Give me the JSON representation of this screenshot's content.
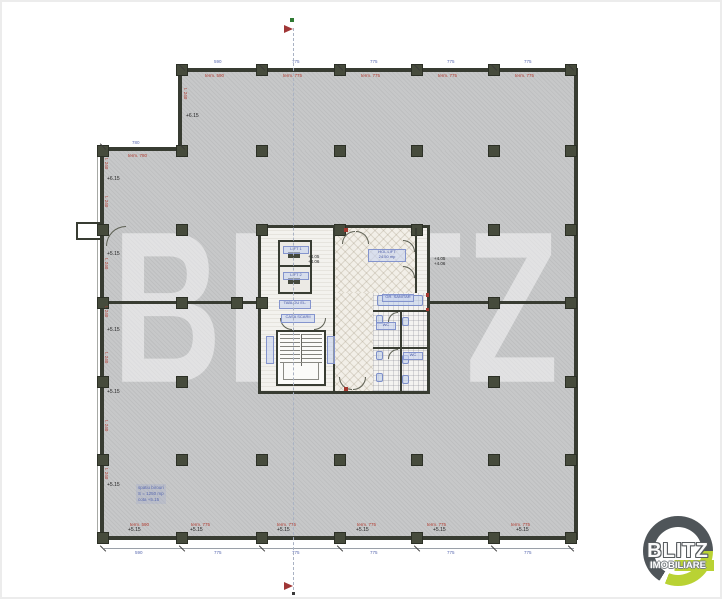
{
  "watermark": {
    "text": "BLITZ"
  },
  "logo": {
    "title": "BLITZ",
    "subtitle": "IMOBILIARE",
    "colors": {
      "ring": "#4f5559",
      "accent": "#b9d233"
    }
  },
  "colors": {
    "floor": "#c7c8c9",
    "wall": "#383c32",
    "column": "#464b3c",
    "red_text": "#b03a2e",
    "blue_text": "#5a6ab0",
    "core_floor": "#f3f2ee"
  },
  "plan": {
    "columns": [
      [
        182,
        70
      ],
      [
        262,
        70
      ],
      [
        340,
        70
      ],
      [
        417,
        70
      ],
      [
        494,
        70
      ],
      [
        571,
        70
      ],
      [
        103,
        151
      ],
      [
        182,
        151
      ],
      [
        262,
        151
      ],
      [
        340,
        151
      ],
      [
        417,
        151
      ],
      [
        494,
        151
      ],
      [
        571,
        151
      ],
      [
        103,
        230
      ],
      [
        182,
        230
      ],
      [
        262,
        230
      ],
      [
        340,
        230
      ],
      [
        417,
        230
      ],
      [
        494,
        230
      ],
      [
        571,
        230
      ],
      [
        103,
        303
      ],
      [
        182,
        303
      ],
      [
        237,
        303
      ],
      [
        262,
        303
      ],
      [
        494,
        303
      ],
      [
        571,
        303
      ],
      [
        103,
        382
      ],
      [
        182,
        382
      ],
      [
        494,
        382
      ],
      [
        571,
        382
      ],
      [
        103,
        460
      ],
      [
        182,
        460
      ],
      [
        262,
        460
      ],
      [
        340,
        460
      ],
      [
        417,
        460
      ],
      [
        494,
        460
      ],
      [
        571,
        460
      ],
      [
        103,
        538
      ],
      [
        182,
        538
      ],
      [
        262,
        538
      ],
      [
        340,
        538
      ],
      [
        417,
        538
      ],
      [
        494,
        538
      ],
      [
        571,
        538
      ]
    ],
    "ticks": [
      [
        182,
        67
      ],
      [
        262,
        67
      ],
      [
        340,
        67
      ],
      [
        417,
        67
      ],
      [
        494,
        67
      ],
      [
        571,
        67
      ],
      [
        103,
        146
      ],
      [
        182,
        146
      ],
      [
        103,
        548
      ],
      [
        182,
        548
      ],
      [
        262,
        548
      ],
      [
        340,
        548
      ],
      [
        417,
        548
      ],
      [
        494,
        548
      ],
      [
        571,
        548
      ]
    ],
    "elevation_labels": [
      {
        "x": 186,
        "y": 114,
        "t": "+6.15"
      },
      {
        "x": 107,
        "y": 177,
        "t": "+6.15"
      },
      {
        "x": 107,
        "y": 252,
        "t": "+5.15"
      },
      {
        "x": 107,
        "y": 328,
        "t": "+5.15"
      },
      {
        "x": 107,
        "y": 390,
        "t": "+5.15"
      },
      {
        "x": 107,
        "y": 483,
        "t": "+5.15"
      },
      {
        "x": 128,
        "y": 528,
        "t": "+5.15"
      },
      {
        "x": 190,
        "y": 528,
        "t": "+5.15"
      },
      {
        "x": 277,
        "y": 528,
        "t": "+5.15"
      },
      {
        "x": 356,
        "y": 528,
        "t": "+5.15"
      },
      {
        "x": 433,
        "y": 528,
        "t": "+5.15"
      },
      {
        "x": 516,
        "y": 528,
        "t": "+5.15"
      }
    ],
    "red_labels": [
      {
        "x": 205,
        "y": 73,
        "t": "term. 590",
        "v": false
      },
      {
        "x": 283,
        "y": 73,
        "t": "term. 775",
        "v": false
      },
      {
        "x": 361,
        "y": 73,
        "t": "term. 775",
        "v": false
      },
      {
        "x": 438,
        "y": 73,
        "t": "term. 775",
        "v": false
      },
      {
        "x": 515,
        "y": 73,
        "t": "term. 775",
        "v": false
      },
      {
        "x": 128,
        "y": 153,
        "t": "term. 780",
        "v": false
      },
      {
        "x": 130,
        "y": 522,
        "t": "term. 590",
        "v": false
      },
      {
        "x": 191,
        "y": 522,
        "t": "term. 775",
        "v": false
      },
      {
        "x": 277,
        "y": 522,
        "t": "term. 775",
        "v": false
      },
      {
        "x": 357,
        "y": 522,
        "t": "term. 775",
        "v": false
      },
      {
        "x": 427,
        "y": 522,
        "t": "term. 775",
        "v": false
      },
      {
        "x": 511,
        "y": 522,
        "t": "term. 775",
        "v": false
      },
      {
        "x": 104,
        "y": 158,
        "t": "t. 240",
        "v": true
      },
      {
        "x": 104,
        "y": 196,
        "t": "t. 240",
        "v": true
      },
      {
        "x": 104,
        "y": 258,
        "t": "t. 240",
        "v": true
      },
      {
        "x": 104,
        "y": 306,
        "t": "t. 240",
        "v": true
      },
      {
        "x": 104,
        "y": 352,
        "t": "t. 240",
        "v": true
      },
      {
        "x": 104,
        "y": 420,
        "t": "t. 240",
        "v": true
      },
      {
        "x": 104,
        "y": 468,
        "t": "t. 240",
        "v": true
      },
      {
        "x": 183,
        "y": 88,
        "t": "t. 240",
        "v": true
      }
    ],
    "blue_dims": [
      {
        "x": 214,
        "y": 59,
        "t": "590"
      },
      {
        "x": 292,
        "y": 59,
        "t": "775"
      },
      {
        "x": 370,
        "y": 59,
        "t": "775"
      },
      {
        "x": 447,
        "y": 59,
        "t": "775"
      },
      {
        "x": 524,
        "y": 59,
        "t": "775"
      },
      {
        "x": 132,
        "y": 140,
        "t": "780"
      },
      {
        "x": 135,
        "y": 550,
        "t": "590"
      },
      {
        "x": 214,
        "y": 550,
        "t": "775"
      },
      {
        "x": 292,
        "y": 550,
        "t": "775"
      },
      {
        "x": 370,
        "y": 550,
        "t": "775"
      },
      {
        "x": 447,
        "y": 550,
        "t": "775"
      },
      {
        "x": 524,
        "y": 550,
        "t": "775"
      }
    ],
    "hall_levels": [
      {
        "x": 308,
        "y": 254,
        "lines": [
          "+4.05",
          "+4.06"
        ]
      },
      {
        "x": 434,
        "y": 256,
        "lines": [
          "+4.05",
          "+4.06"
        ]
      }
    ],
    "room_chips": [
      {
        "x": 283,
        "y": 246,
        "w": 26,
        "h": 8,
        "lines": [
          "LIFT 1"
        ]
      },
      {
        "x": 283,
        "y": 272,
        "w": 26,
        "h": 8,
        "lines": [
          "LIFT 2"
        ]
      },
      {
        "x": 279,
        "y": 300,
        "w": 32,
        "h": 9,
        "lines": [
          "TABLOU EL."
        ]
      },
      {
        "x": 281,
        "y": 314,
        "w": 34,
        "h": 9,
        "lines": [
          "CASA SCARII"
        ]
      },
      {
        "x": 266,
        "y": 336,
        "w": 8,
        "h": 28,
        "lines": [
          ""
        ]
      },
      {
        "x": 327,
        "y": 336,
        "w": 8,
        "h": 28,
        "lines": [
          ""
        ]
      },
      {
        "x": 368,
        "y": 249,
        "w": 38,
        "h": 13,
        "lines": [
          "HOL LIFT",
          "24.50 mp"
        ]
      },
      {
        "x": 382,
        "y": 294,
        "w": 32,
        "h": 8,
        "lines": [
          "GR. SANITAR"
        ]
      },
      {
        "x": 376,
        "y": 322,
        "w": 20,
        "h": 8,
        "lines": [
          "WC"
        ]
      },
      {
        "x": 403,
        "y": 352,
        "w": 20,
        "h": 8,
        "lines": [
          "WC"
        ]
      }
    ],
    "office_note": {
      "x": 136,
      "y": 484,
      "lines": [
        "spatiu birouri",
        "S = 1250 mp",
        "cota +5.15"
      ]
    }
  }
}
